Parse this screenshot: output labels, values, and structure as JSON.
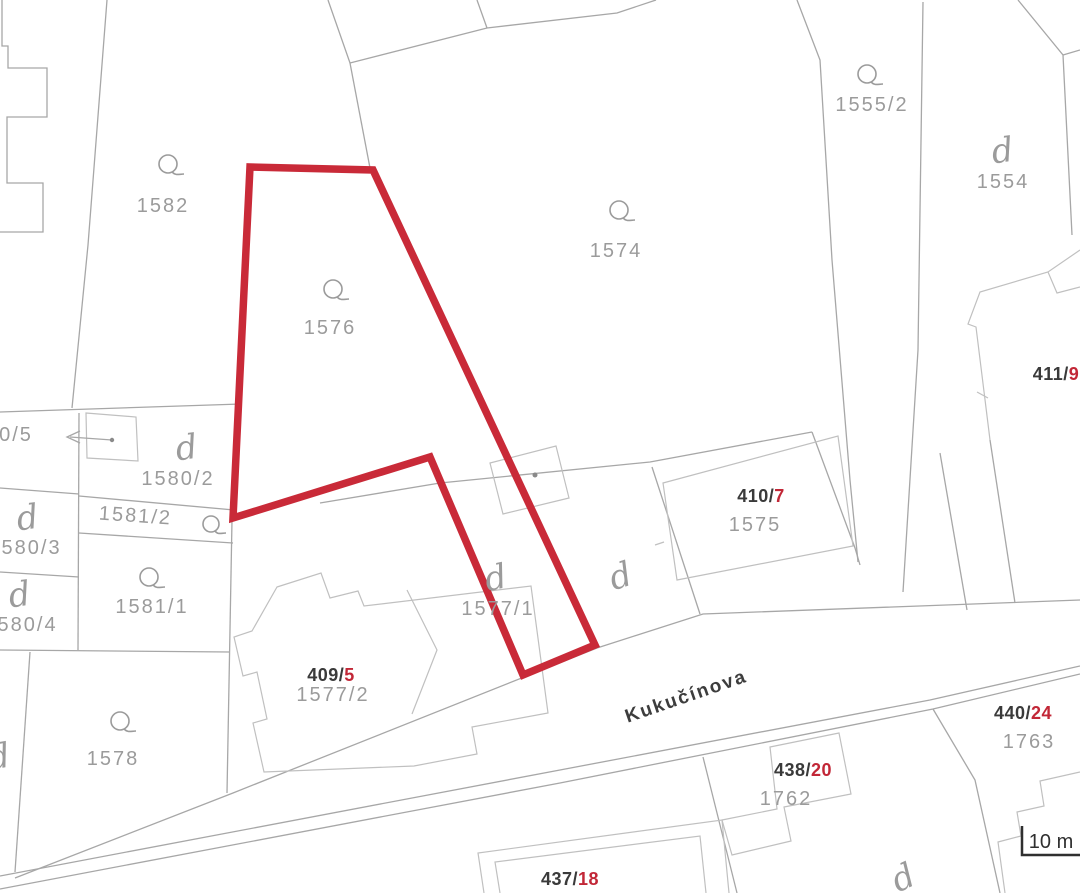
{
  "street": {
    "name": "Kukučínova"
  },
  "scale_bar": {
    "label": "10 m"
  },
  "symbols": {
    "yard": "d"
  },
  "parcels": {
    "p1582": "1582",
    "p1576": "1576",
    "p1574": "1574",
    "p1555_2": "1555/2",
    "p1554": "1554",
    "p1575": "1575",
    "p1577_1": "1577/1",
    "p1580_2": "1580/2",
    "p0_5": "0/5",
    "p1581_2": "1581/2",
    "p1580_3": "1580/3",
    "p1581_1": "1581/1",
    "p1580_4": "1580/4",
    "p1578": "1578",
    "p1577_2": "1577/2",
    "p1762": "1762",
    "p1763": "1763"
  },
  "building_numbers": {
    "b411": {
      "main": "411/",
      "orient": "9"
    },
    "b410": {
      "main": "410/",
      "orient": "7"
    },
    "b409": {
      "main": "409/",
      "orient": "5"
    },
    "b440": {
      "main": "440/",
      "orient": "24"
    },
    "b438": {
      "main": "438/",
      "orient": "20"
    },
    "b437": {
      "main": "437/",
      "orient": "18"
    }
  },
  "colors": {
    "highlight": "#c92a38",
    "boundary": "#a7a7a7",
    "building_line": "#c0c0c0",
    "parcel_label": "#9b9b9b",
    "building_number": "#3a3a3a",
    "orientation_number": "#c22737"
  }
}
